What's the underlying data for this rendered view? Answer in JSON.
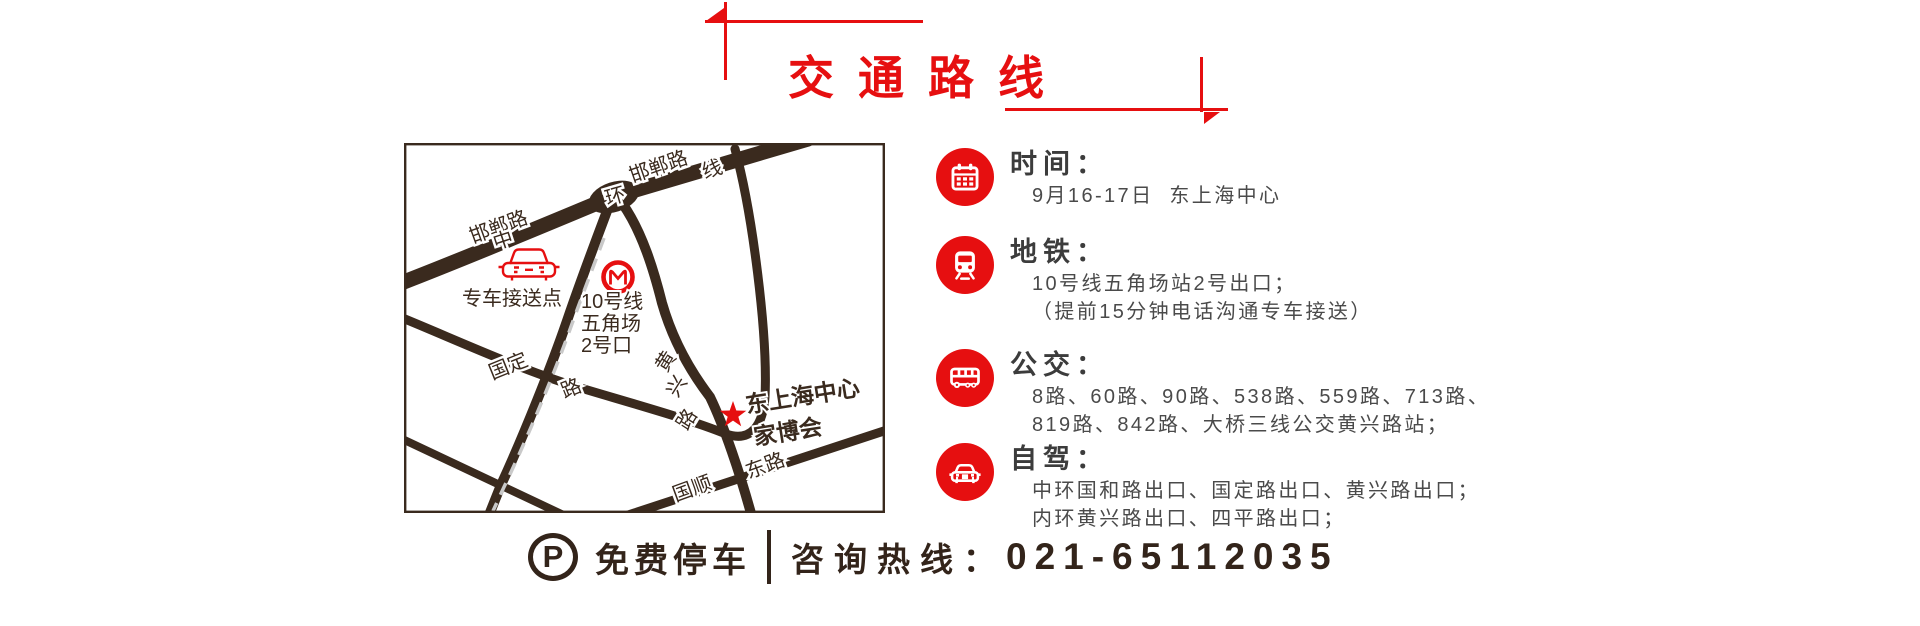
{
  "title": "交通路线",
  "map": {
    "roads": {
      "handan_left": "邯郸路",
      "zhong": "中",
      "huan": "环",
      "handan_top": "邯郸路",
      "xian": "线",
      "guoding": "国定",
      "guoding_lu": "路",
      "huangxing_1": "黄",
      "huangxing_2": "兴",
      "huangxing_3": "路",
      "guoshun": "国顺",
      "donglu": "东路"
    },
    "shuttle_point": "专车接送点",
    "metro_exit_line1": "10号线",
    "metro_exit_line2": "五角场",
    "metro_exit_line3": "2号口",
    "venue_line1": "东上海中心",
    "venue_line2": "家博会"
  },
  "info": [
    {
      "title": "时间：",
      "lines": [
        "9月16-17日  东上海中心"
      ]
    },
    {
      "title": "地铁：",
      "lines": [
        "10号线五角场站2号出口；",
        "（提前15分钟电话沟通专车接送）"
      ]
    },
    {
      "title": "公交：",
      "lines": [
        "8路、60路、90路、538路、559路、713路、",
        "819路、842路、大桥三线公交黄兴路站；"
      ]
    },
    {
      "title": "自驾：",
      "lines": [
        "中环国和路出口、国定路出口、黄兴路出口；",
        "内环黄兴路出口、四平路出口；"
      ]
    }
  ],
  "footer": {
    "parking_letter": "P",
    "parking": "免费停车",
    "hotline": "咨询热线：",
    "phone": "021-65112035"
  },
  "colors": {
    "red": "#e60f10",
    "map_dark": "#3a2a1e",
    "text": "#3c3c3c"
  }
}
